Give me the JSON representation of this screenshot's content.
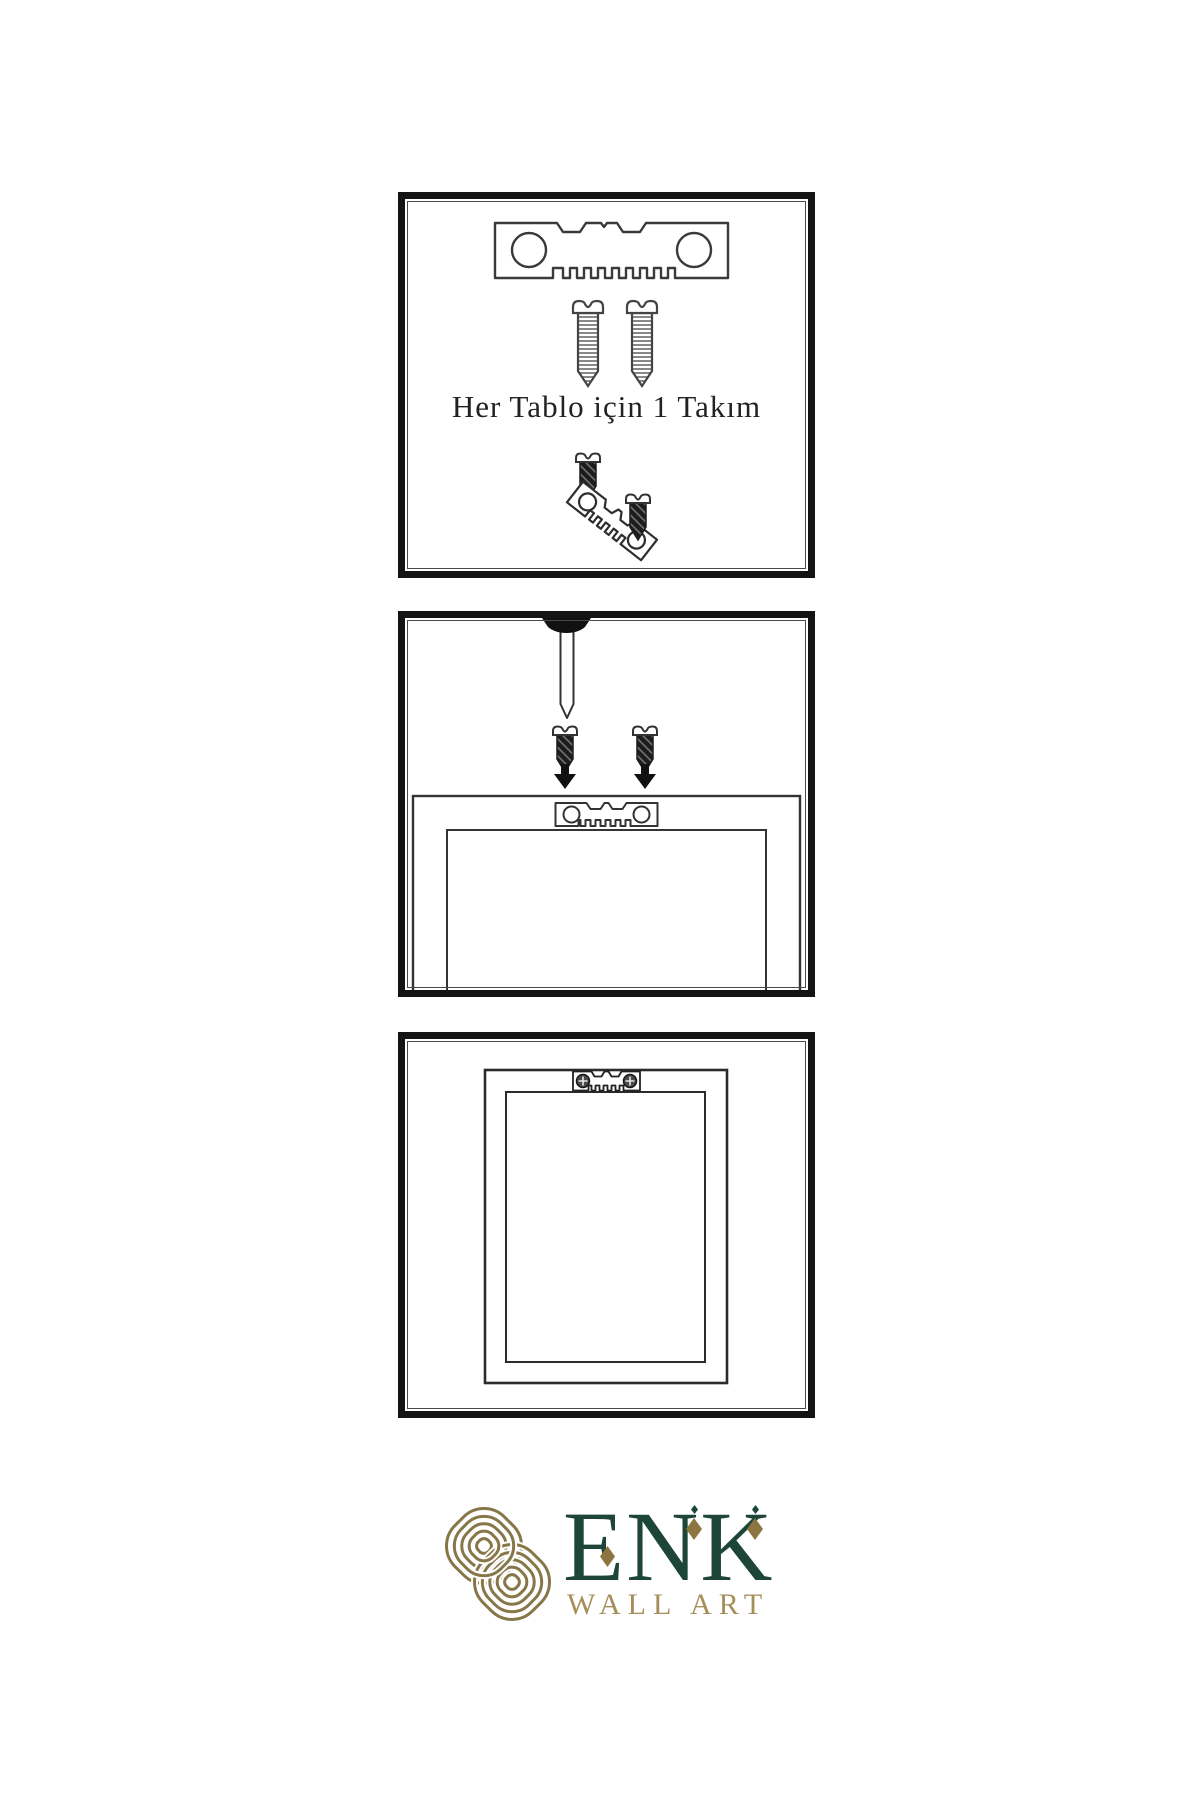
{
  "page": {
    "background": "#ffffff"
  },
  "colors": {
    "panel_border": "#141414",
    "line_art": "#3a3a3a",
    "dark_hardware": "#1c1c1c",
    "brand_green": "#1d4639",
    "brand_gold": "#8c7540",
    "brand_gold_light": "#a68e58"
  },
  "panels": [
    {
      "id": "hardware-kit",
      "caption": "Her Tablo için 1 Takım",
      "icons": [
        "sawtooth-hanger-icon",
        "screw-icon",
        "screw-icon",
        "screw-icon",
        "tilted-sawtooth-hanger-icon",
        "screw-icon"
      ]
    },
    {
      "id": "mounting-step",
      "icons": [
        "wall-nail-icon",
        "screw-icon",
        "screw-icon",
        "arrow-down-icon",
        "arrow-down-icon",
        "sawtooth-hanger-icon",
        "frame-back-icon"
      ]
    },
    {
      "id": "hung-frame-step",
      "icons": [
        "frame-front-icon",
        "mounted-sawtooth-hanger-icon",
        "phillips-screw-icon",
        "phillips-screw-icon"
      ]
    }
  ],
  "logo": {
    "emblem": "interlocking-knot-icon",
    "brand": "ENK",
    "tagline": "WALL ART"
  }
}
